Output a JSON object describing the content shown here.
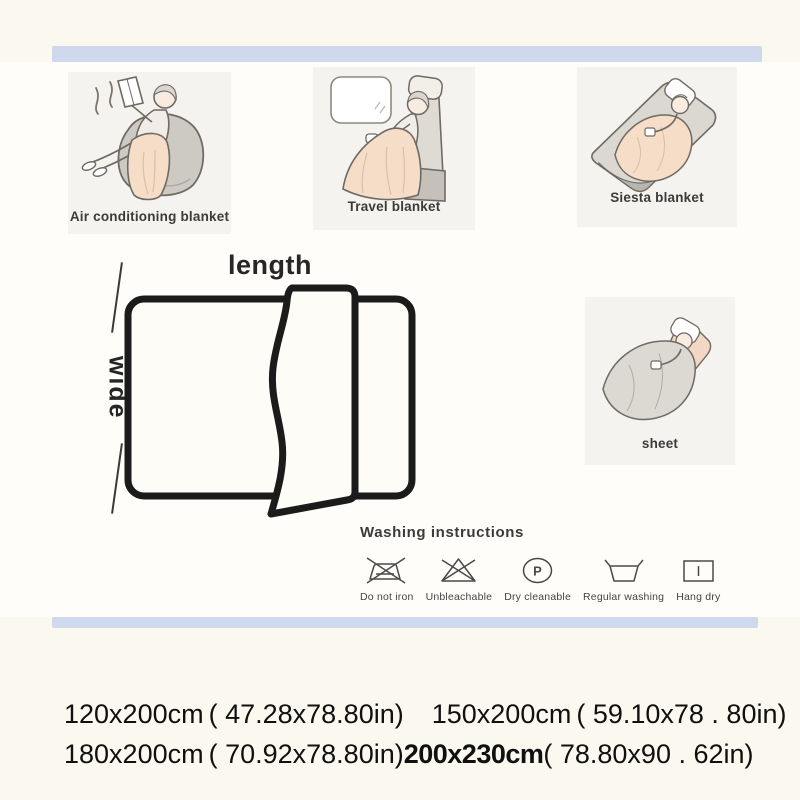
{
  "page": {
    "background": "#fbf8ef",
    "content_background": "#fefdfa",
    "divider_color": "#cfd9ee",
    "blanket_color": "#f5ddc7",
    "furniture_color": "#cdc9c3"
  },
  "scenes": [
    {
      "label": "Air conditioning blanket"
    },
    {
      "label": "Travel blanket"
    },
    {
      "label": "Siesta blanket"
    },
    {
      "label": "sheet"
    }
  ],
  "diagram": {
    "length_label": "length",
    "wide_label": "wide"
  },
  "washing": {
    "title": "Washing instructions",
    "items": [
      {
        "label": "Do not iron"
      },
      {
        "label": "Unbleachable"
      },
      {
        "label": "Dry cleanable",
        "symbol": "P"
      },
      {
        "label": "Regular washing"
      },
      {
        "label": "Hang dry"
      }
    ]
  },
  "sizes": {
    "line1": [
      {
        "cm": "120x200cm",
        "in": "( 47.28x78.80in)"
      },
      {
        "cm": "150x200cm",
        "in": "( 59.10x78 . 80in)"
      }
    ],
    "line2": [
      {
        "cm": "180x200cm",
        "in": "( 70.92x78.80in)"
      },
      {
        "cm": "200x230cm",
        "in": "( 78.80x90 . 62in)"
      }
    ]
  }
}
